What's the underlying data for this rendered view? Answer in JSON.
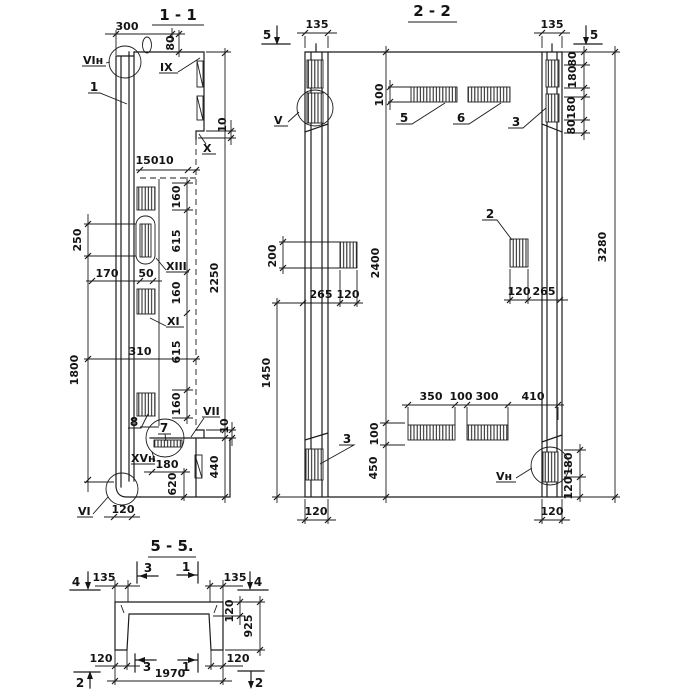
{
  "s11": {
    "title": "1 - 1",
    "part1": "1",
    "part7": "7",
    "part8": "8",
    "lbl_vin": "VIн",
    "lbl_ix": "IX",
    "lbl_x": "X",
    "lbl_xiii": "XIII",
    "lbl_xi": "XI",
    "lbl_vii": "VII",
    "lbl_xvn": "XVн",
    "lbl_vi": "VI",
    "d300": "300",
    "d80": "80",
    "d150": "150",
    "d10_1": "10",
    "d10_2": "10",
    "d10_3": "10",
    "d160_1": "160",
    "d615_1": "615",
    "d160_2": "160",
    "d615_2": "615",
    "d160_3": "160",
    "d2250": "2250",
    "d250": "250",
    "d1800": "1800",
    "d170": "170",
    "d50": "50",
    "d310": "310",
    "d440": "440",
    "d180": "180",
    "d620": "620",
    "d120": "120"
  },
  "s22": {
    "title": "2 - 2",
    "cut5_left": "5",
    "cut5_right": "5",
    "d135_left": "135",
    "d135_right": "135",
    "lbl_v": "V",
    "lbl_vn": "Vн",
    "part5": "5",
    "part6": "6",
    "part3_top": "3",
    "part3_bottom": "3",
    "part2": "2",
    "d100_top": "100",
    "d80_1": "80",
    "d180_1": "180",
    "d180_2": "180",
    "d80_2": "80",
    "d200": "200",
    "d2400": "2400",
    "d3280": "3280",
    "d1450": "1450",
    "d265_left": "265",
    "d120_left": "120",
    "d120_right": "120",
    "d265_right": "265",
    "d350": "350",
    "d100_mid": "100",
    "d300": "300",
    "d410": "410",
    "d100_left": "100",
    "d450": "450",
    "d180_br": "180",
    "d120_br": "120",
    "d120_bot_left": "120",
    "d120_bot_right": "120"
  },
  "s55": {
    "title": "5 - 5.",
    "cut4_left": "4",
    "cut4_right": "4",
    "cut3_top": "3",
    "cut1_top": "1",
    "cut3_bottom": "3",
    "cut1_bottom": "1",
    "cut2_left": "2",
    "cut2_right": "2",
    "d135_left": "135",
    "d135_right": "135",
    "d120_slab": "120",
    "d925": "925",
    "d120_leg_left": "120",
    "d120_leg_right": "120",
    "d1970": "1970"
  }
}
